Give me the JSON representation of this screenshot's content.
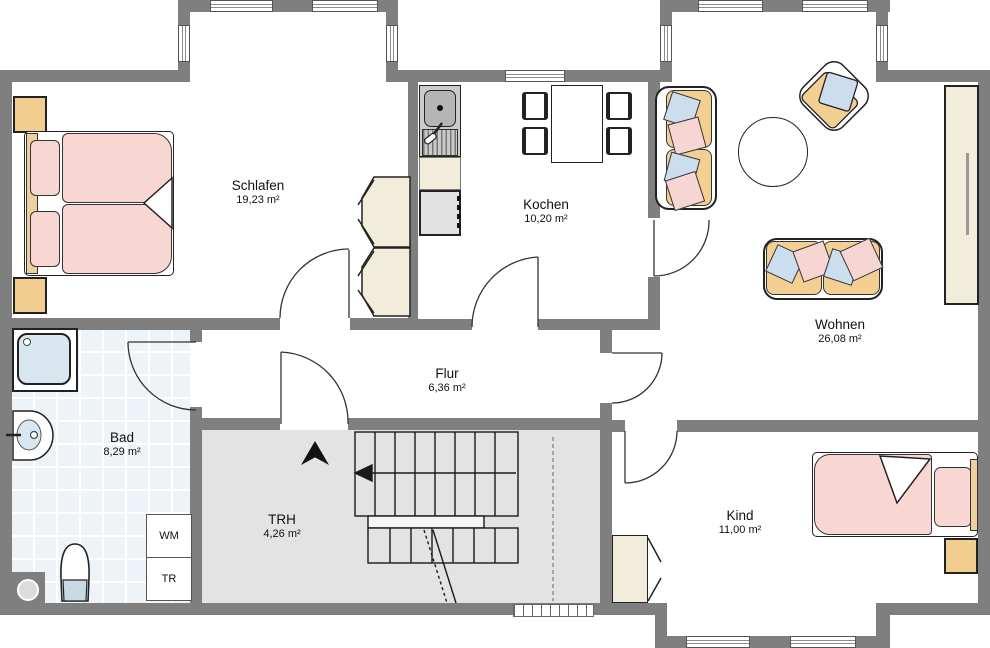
{
  "rooms": {
    "schlafen": {
      "name": "Schlafen",
      "area": "19,23 m²"
    },
    "kochen": {
      "name": "Kochen",
      "area": "10,20 m²"
    },
    "wohnen": {
      "name": "Wohnen",
      "area": "26,08 m²"
    },
    "flur": {
      "name": "Flur",
      "area": "6,36 m²"
    },
    "bad": {
      "name": "Bad",
      "area": "8,29 m²"
    },
    "trh": {
      "name": "TRH",
      "area": "4,26 m²"
    },
    "kind": {
      "name": "Kind",
      "area": "11,00 m²"
    }
  },
  "appliances": {
    "wm": "WM",
    "tr": "TR"
  },
  "icons": {
    "north": "north-arrow-icon"
  },
  "colors": {
    "wall": "#7f7f7f",
    "furniture_wood": "#f1cd90",
    "bedding_pink": "#f8d7d3",
    "pillow_blue": "#ccdded",
    "cabinet_cream": "#f2ecda",
    "bath_tile": "#edf3f7",
    "stair_floor": "#e3e3e3"
  }
}
